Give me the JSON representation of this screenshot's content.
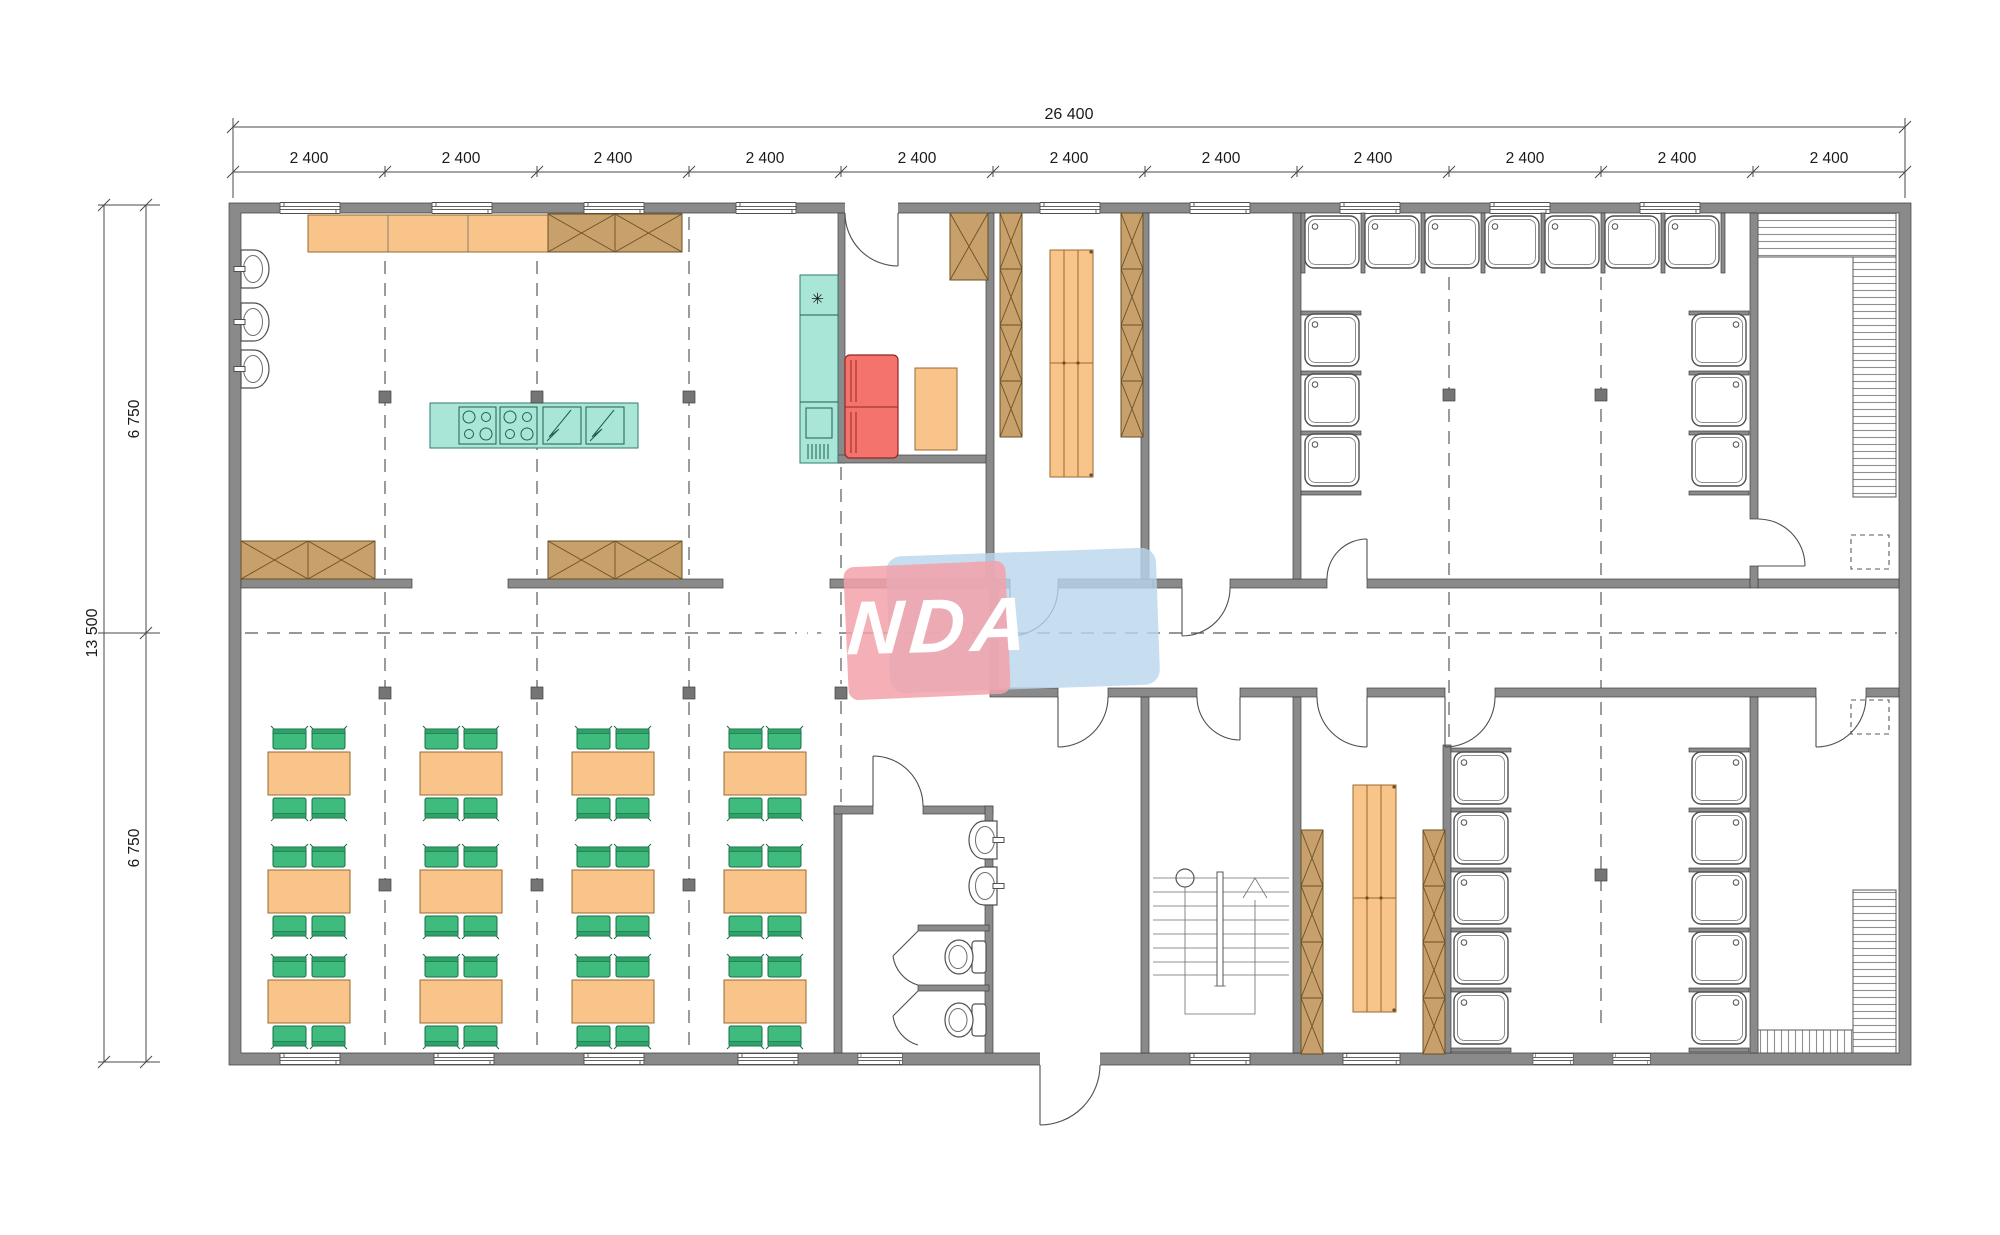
{
  "watermark": {
    "text": "VANDA",
    "pink": "#f2a2a9",
    "blue": "#b9d6ee"
  },
  "dimensions": {
    "total_width_label": "26 400",
    "bay_labels": [
      "2 400",
      "2 400",
      "2 400",
      "2 400",
      "2 400",
      "2 400",
      "2 400",
      "2 400",
      "2 400",
      "2 400",
      "2 400"
    ],
    "total_height_label": "13 500",
    "half_height_labels": [
      "6 750",
      "6 750"
    ]
  },
  "icons": {
    "freezer_symbol": "✳"
  },
  "colors": {
    "wall": "#8a8a8a",
    "wood": "#f8c489",
    "wood-dark": "#c7a06b",
    "teal": "#a9e6d8",
    "fridge-red": "#f4736c",
    "seat-green": "#3fbc7d"
  }
}
